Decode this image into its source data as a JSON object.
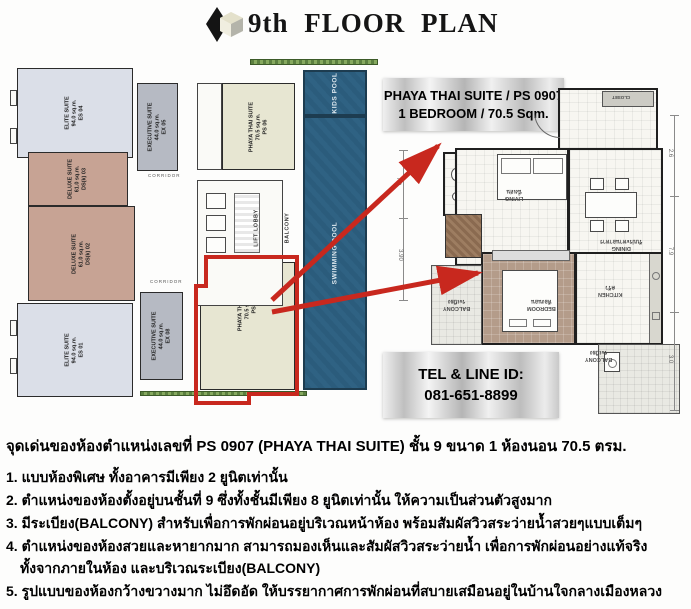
{
  "header": {
    "title": "9th FLOOR PLAN"
  },
  "callout": {
    "line1": "PHAYA THAI SUITE / PS 0907",
    "line2": "1 BEDROOM / 70.5 Sqm."
  },
  "contact": {
    "line1": "TEL & LINE ID:",
    "line2": "081-651-8899"
  },
  "floor_plan": {
    "units": [
      {
        "name": "ELITE SUITE",
        "area": "94.0 sq.m.",
        "id": "ES 04"
      },
      {
        "name": "EXECUTIVE SUITE",
        "area": "44.0 sq.m.",
        "id": "EX 05"
      },
      {
        "name": "PHAYA THAI SUITE",
        "area": "70.5 sq.m.",
        "id": "PS 06"
      },
      {
        "name": "DELUXE SUITE",
        "area": "61.0 sq.m.",
        "id": "DS(k) 03"
      },
      {
        "name": "DELUXE SUITE",
        "area": "61.0 sq.m.",
        "id": "DS(k) 02"
      },
      {
        "name": "ELITE SUITE",
        "area": "94.0 sq.m.",
        "id": "ES 01"
      },
      {
        "name": "EXECUTIVE SUITE",
        "area": "44.0 sq.m.",
        "id": "EX 08"
      },
      {
        "name": "PHAYA THAI SUITE",
        "area": "70.5 sq.m.",
        "id": "PS 07"
      }
    ],
    "labels": {
      "lift_lobby": "LIFT LOBBY",
      "balcony": "BALCONY",
      "kids_pool": "KIDS POOL",
      "swimming_pool": "SWIMMING POOL",
      "corridor": "CORRIDOR"
    },
    "dimensions": [
      "7.9",
      "3.90"
    ]
  },
  "unit_plan": {
    "rooms": {
      "living": {
        "en": "LIVING",
        "th": "นั่งเล่น"
      },
      "dining": {
        "en": "DINING",
        "th": "รับประทานอาหาร"
      },
      "bedroom": {
        "en": "BEDROOM",
        "th": "ห้องนอน"
      },
      "kitchen": {
        "en": "KITCHEN",
        "th": "ครัว"
      },
      "balcony_front": {
        "en": "BALCONY",
        "th": "ระเบียง"
      },
      "balcony_service": {
        "en": "BALCONY",
        "th": "ระเบียง"
      },
      "closet": {
        "en": "CLOSET",
        "th": ""
      }
    },
    "dimensions": [
      "2.6",
      "7.9",
      "3.0"
    ]
  },
  "description": {
    "headline": "จุดเด่นของห้องตำแหน่งเลขที่ PS 0907 (PHAYA THAI SUITE) ชั้น 9 ขนาด 1 ห้องนอน 70.5 ตรม.",
    "lines": [
      "1. แบบห้องพิเศษ ทั้งอาคารมีเพียง 2 ยูนิตเท่านั้น",
      "2. ตำแหน่งของห้องตั้งอยู่บนชั้นที่ 9 ซึ่งทั้งชั้นมีเพียง 8 ยูนิตเท่านั้น ให้ความเป็นส่วนตัวสูงมาก",
      "3. มีระเบียง(BALCONY) สำหรับเพื่อการพักผ่อนอยู่บริเวณหน้าห้อง พร้อมสัมผัสวิวสระว่ายน้ำสวยๆแบบเต็มๆ",
      "4. ตำแหน่งของห้องสวยและหายากมาก สามารถมองเห็นและสัมผัสวิวสระว่ายน้ำ เพื่อการพักผ่อนอย่างแท้จริง",
      "ทั้งจากภายในห้อง และบริเวณระเบียง(BALCONY)",
      "5. รูปแบบของห้องกว้างขวางมาก ไม่อึดอัด ให้บรรยากาศการพักผ่อนที่สบายเสมือนอยู่ในบ้านใจกลางเมืองหลวง"
    ]
  },
  "colors": {
    "accent_red": "#c8281e",
    "pool_blue": "#2b5c7c",
    "elite_fill": "#dbdfe8",
    "deluxe_fill": "#c7a394",
    "executive_fill": "#b6bac3",
    "phaya_fill": "#e7e6d2"
  }
}
